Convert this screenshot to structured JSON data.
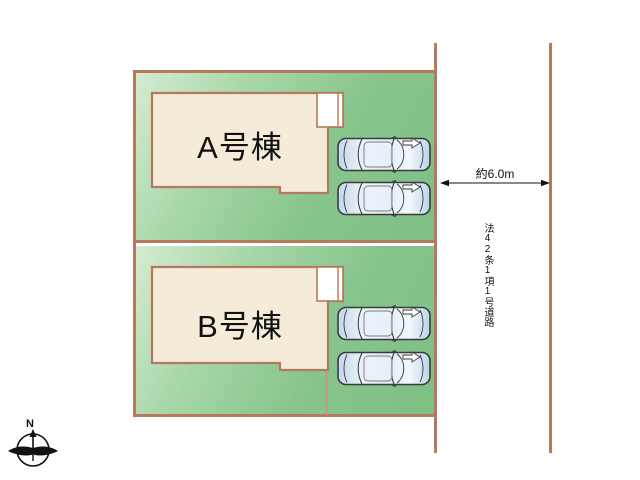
{
  "plan": {
    "building_a_label": "A号棟",
    "building_b_label": "B号棟",
    "road_width_label": "約6.0m",
    "road_name": "法42条1項1号道路",
    "compass_north": "N",
    "car_count": 4,
    "unit_count": 2
  },
  "colors": {
    "plot_border": "#b5795d",
    "plot_green_light": "#d4ecd0",
    "plot_green_dark": "#7ebf84",
    "building_fill": "#f4ebd9",
    "porch_fill": "#ffffff",
    "car_body_blue": "#cfe2f2",
    "outline_dark": "#3a3a3a"
  }
}
